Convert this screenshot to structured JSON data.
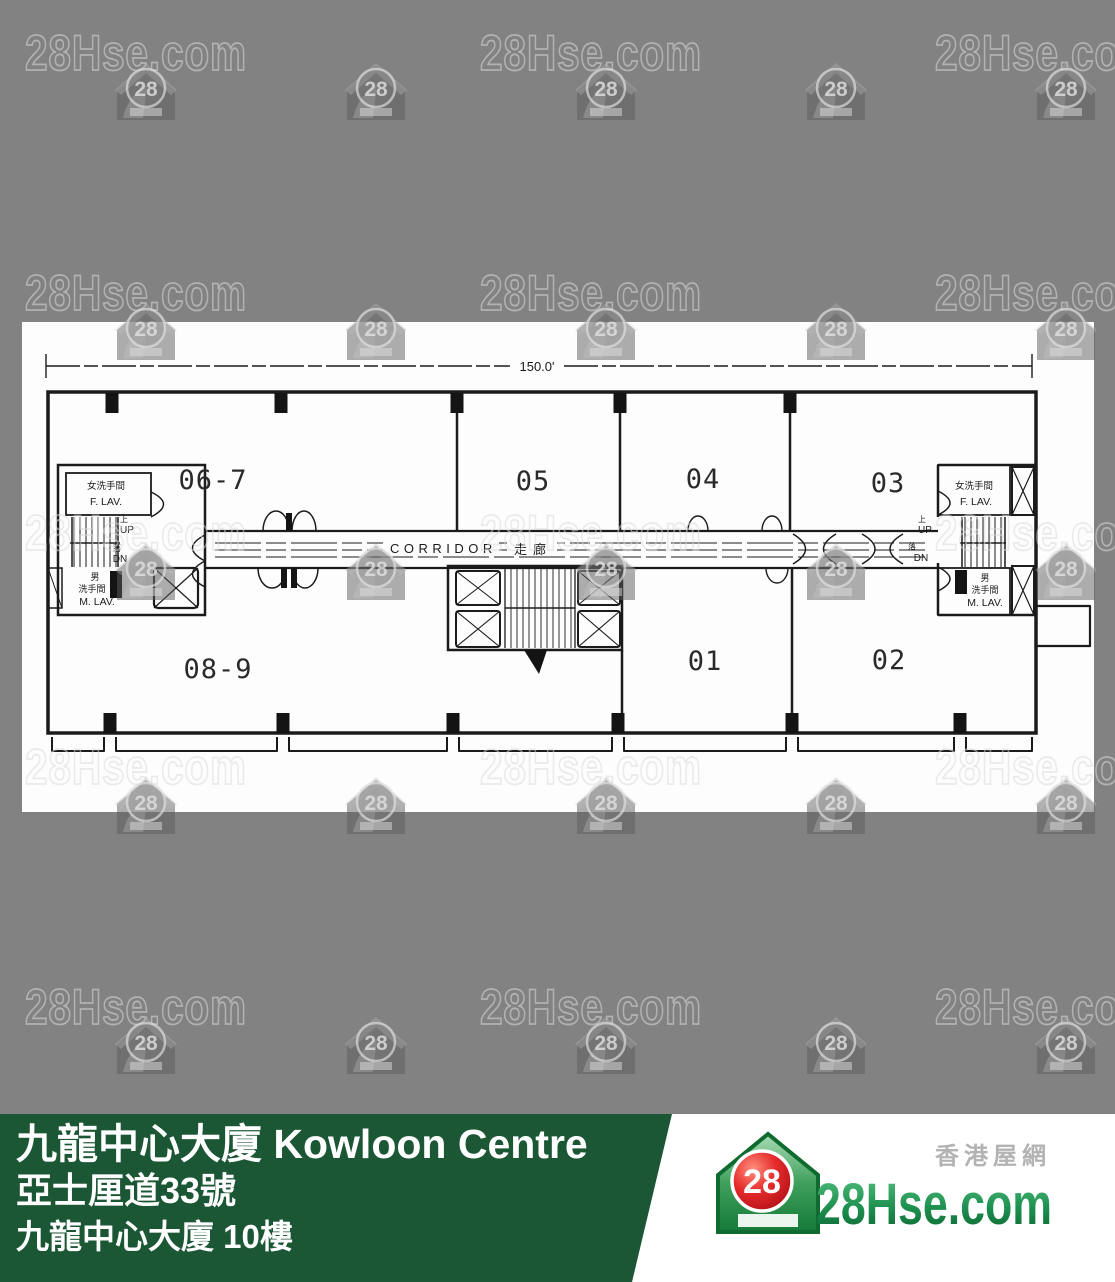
{
  "watermark": {
    "text": "28Hse.com",
    "badge": "28"
  },
  "plan": {
    "dimension_label": "150.0'",
    "corridor_en": "CORRIDOR",
    "corridor_zh": "走廊",
    "units": [
      "06-7",
      "05",
      "04",
      "03",
      "08-9",
      "01",
      "02"
    ],
    "f_lav_zh": "女洗手間",
    "f_lav_en": "F. LAV.",
    "m_lav_zh1": "男",
    "m_lav_zh2": "洗手間",
    "m_lav_en": "M. LAV.",
    "up_zh": "上",
    "up_en": "UP",
    "dn_zh": "落",
    "dn_en": "DN"
  },
  "banner": {
    "title": "九龍中心大廈 Kowloon Centre",
    "address": "亞士厘道33號",
    "floor": "九龍中心大廈 10樓",
    "bg_color": "#1b5635"
  },
  "logo": {
    "brand": "28Hse.com",
    "tagline": "香港屋網",
    "badge": "28",
    "green": "#1e7a3c",
    "red": "#d61a23"
  }
}
